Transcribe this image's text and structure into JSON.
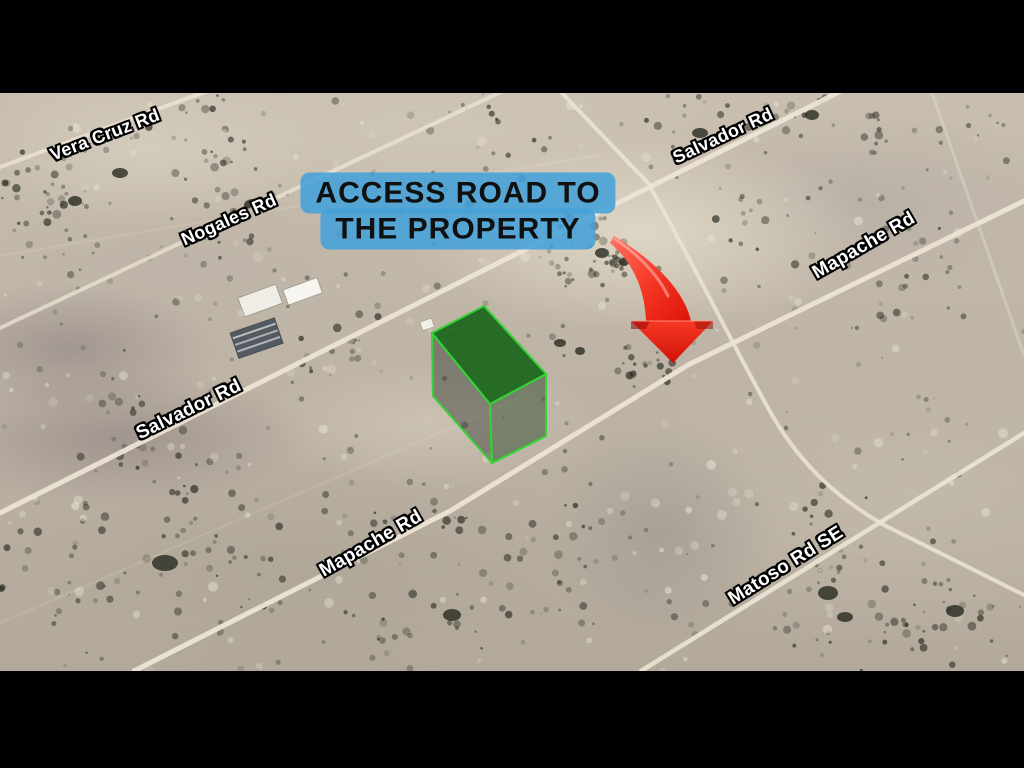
{
  "window": {
    "width": 1024,
    "height": 768,
    "letterbox_color": "#000000"
  },
  "map": {
    "top": 93,
    "height": 578,
    "road_labels": [
      {
        "id": "vera-cruz-rd",
        "text": "Vera Cruz Rd",
        "x": 105,
        "y": 135,
        "rot": -21,
        "size": 18
      },
      {
        "id": "nogales-rd",
        "text": "Nogales Rd",
        "x": 229,
        "y": 220,
        "rot": -24,
        "size": 18
      },
      {
        "id": "salvador-rd-top",
        "text": "Salvador Rd",
        "x": 723,
        "y": 136,
        "rot": -25,
        "size": 18
      },
      {
        "id": "mapache-rd-top",
        "text": "Mapache Rd",
        "x": 864,
        "y": 246,
        "rot": -30,
        "size": 19
      },
      {
        "id": "salvador-rd-sw",
        "text": "Salvador Rd",
        "x": 189,
        "y": 410,
        "rot": -26,
        "size": 19
      },
      {
        "id": "mapache-rd-sw",
        "text": "Mapache Rd",
        "x": 371,
        "y": 544,
        "rot": -30,
        "size": 19
      },
      {
        "id": "matoso-rd-se",
        "text": "Matoso Rd SE",
        "x": 786,
        "y": 566,
        "rot": -32,
        "size": 19
      }
    ],
    "callout": {
      "line1": "ACCESS ROAD TO",
      "line2": "THE PROPERTY",
      "x": 458,
      "y": 211
    },
    "colors": {
      "callout_blue": "#44A0D9",
      "callout_text": "#101010",
      "arrow_red": "#EE2014",
      "arrow_dark_red": "#A8120A",
      "parcel_green_top": "#1E6B1F",
      "parcel_edge_green": "#33D433",
      "road_color": "#ECE4D4",
      "desert_base": "#BDB3A4",
      "label_text": "#FFFFFF",
      "label_outline": "#000000"
    }
  }
}
